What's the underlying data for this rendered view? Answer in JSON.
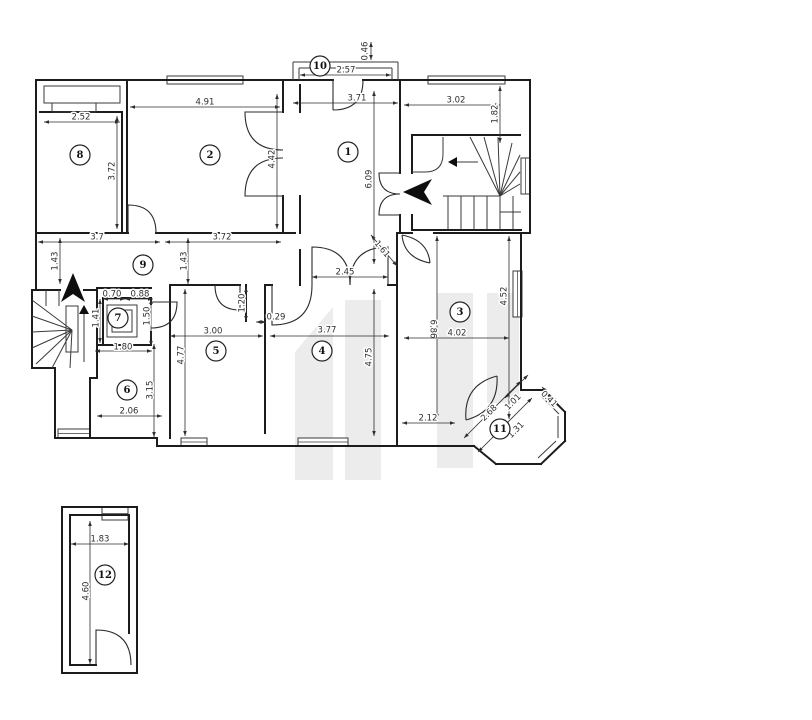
{
  "palette": {
    "background": "#ffffff",
    "wall": "#1c1c1c",
    "thin_line": "#3a3a3a",
    "door": "#2b2b2b",
    "dim": "#2e2e2e",
    "arrow_fill": "#0e0e0e",
    "watermark": "#ececec",
    "badge_fill": "#ffffff",
    "badge_stroke": "#222222"
  },
  "plan": {
    "walls": [
      [
        36,
        80,
        293,
        80
      ],
      [
        398,
        80,
        530,
        80
      ],
      [
        530,
        80,
        530,
        233
      ],
      [
        530,
        233,
        521,
        233
      ],
      [
        521,
        233,
        521,
        390
      ],
      [
        521,
        390,
        543,
        390
      ],
      [
        543,
        390,
        565,
        412
      ],
      [
        565,
        412,
        565,
        441
      ],
      [
        565,
        441,
        541,
        464
      ],
      [
        541,
        464,
        496,
        464
      ],
      [
        496,
        464,
        474,
        446
      ],
      [
        474,
        446,
        157,
        446
      ],
      [
        157,
        446,
        157,
        438
      ],
      [
        157,
        438,
        55,
        438
      ],
      [
        55,
        438,
        55,
        368
      ],
      [
        55,
        368,
        32,
        368
      ],
      [
        32,
        368,
        32,
        290
      ],
      [
        32,
        290,
        36,
        290
      ],
      [
        36,
        290,
        36,
        80
      ],
      [
        40,
        112,
        122,
        112
      ],
      [
        122,
        112,
        122,
        233
      ],
      [
        127,
        80,
        127,
        233
      ],
      [
        36,
        233,
        128,
        233
      ],
      [
        156,
        233,
        295,
        233
      ],
      [
        283,
        80,
        283,
        112
      ],
      [
        283,
        196,
        283,
        233
      ],
      [
        300,
        85,
        300,
        112
      ],
      [
        300,
        196,
        300,
        233
      ],
      [
        300,
        250,
        300,
        285
      ],
      [
        400,
        80,
        400,
        173
      ],
      [
        400,
        215,
        400,
        233
      ],
      [
        400,
        233,
        412,
        233
      ],
      [
        412,
        135,
        520,
        135
      ],
      [
        412,
        135,
        412,
        173
      ],
      [
        412,
        215,
        412,
        230
      ],
      [
        412,
        230,
        521,
        230
      ],
      [
        397,
        233,
        400,
        233
      ],
      [
        434,
        233,
        521,
        233
      ],
      [
        397,
        233,
        397,
        446
      ],
      [
        170,
        285,
        240,
        285
      ],
      [
        265,
        285,
        272,
        285
      ],
      [
        388,
        285,
        397,
        285
      ],
      [
        246,
        285,
        246,
        321
      ],
      [
        265,
        285,
        265,
        321
      ],
      [
        265,
        321,
        265,
        393
      ],
      [
        265,
        393,
        265,
        433
      ],
      [
        170,
        285,
        170,
        438
      ],
      [
        90,
        438,
        90,
        378
      ],
      [
        90,
        378,
        97,
        378
      ],
      [
        97,
        378,
        97,
        345
      ],
      [
        97,
        345,
        151,
        345
      ],
      [
        103,
        298,
        151,
        298
      ],
      [
        103,
        298,
        103,
        345
      ],
      [
        151,
        298,
        151,
        304
      ],
      [
        151,
        332,
        151,
        345
      ],
      [
        32,
        290,
        60,
        290
      ],
      [
        84,
        290,
        97,
        290
      ],
      [
        97,
        290,
        97,
        368
      ],
      [
        97,
        288,
        151,
        288
      ],
      [
        293,
        80,
        333,
        80
      ],
      [
        363,
        80,
        398,
        80
      ],
      [
        62,
        507,
        137,
        507
      ],
      [
        137,
        507,
        137,
        673
      ],
      [
        137,
        673,
        62,
        673
      ],
      [
        62,
        673,
        62,
        507
      ],
      [
        70,
        515,
        70,
        665
      ],
      [
        70,
        665,
        96,
        665
      ],
      [
        70,
        515,
        129,
        515
      ],
      [
        129,
        515,
        129,
        633
      ]
    ],
    "thin": [
      [
        293,
        62,
        398,
        62
      ],
      [
        293,
        62,
        293,
        80
      ],
      [
        398,
        62,
        398,
        80
      ],
      [
        299,
        68,
        392,
        68
      ],
      [
        299,
        68,
        299,
        80
      ],
      [
        392,
        68,
        392,
        80
      ],
      [
        448,
        196,
        448,
        229
      ],
      [
        461,
        196,
        461,
        229
      ],
      [
        474,
        196,
        474,
        229
      ],
      [
        487,
        196,
        487,
        229
      ],
      [
        500,
        196,
        500,
        229
      ],
      [
        513,
        196,
        513,
        229
      ],
      [
        500,
        212,
        521,
        212
      ],
      [
        443,
        196,
        500,
        196
      ],
      [
        500,
        196,
        470,
        137
      ],
      [
        500,
        196,
        484,
        137
      ],
      [
        500,
        196,
        498,
        137
      ],
      [
        500,
        196,
        512,
        143
      ],
      [
        500,
        196,
        520,
        155
      ],
      [
        500,
        196,
        520,
        172
      ],
      [
        500,
        196,
        520,
        184
      ],
      [
        72,
        330,
        32,
        300
      ],
      [
        72,
        330,
        32,
        316
      ],
      [
        72,
        330,
        32,
        332
      ],
      [
        72,
        330,
        32,
        348
      ],
      [
        72,
        330,
        36,
        364
      ],
      [
        72,
        330,
        52,
        368
      ],
      [
        72,
        330,
        70,
        368
      ],
      [
        46,
        290,
        46,
        306
      ],
      [
        59,
        290,
        59,
        306
      ],
      [
        478,
        162,
        452,
        162
      ],
      [
        84,
        362,
        84,
        312
      ],
      [
        541,
        396,
        559,
        414
      ],
      [
        558,
        416,
        558,
        438
      ],
      [
        556,
        441,
        538,
        458
      ]
    ],
    "paths": [
      "M 412,172 L 425,172 Q 443,172 443,154 L 443,137"
    ],
    "rects": [
      [
        44,
        86,
        76,
        17
      ],
      [
        52,
        103,
        44,
        9
      ],
      [
        107,
        305,
        30,
        32
      ],
      [
        112,
        310,
        20,
        22
      ],
      [
        66,
        306,
        12,
        46
      ]
    ],
    "windows": [
      [
        167,
        76,
        76,
        8
      ],
      [
        428,
        76,
        77,
        8
      ],
      [
        521,
        158,
        9,
        36
      ],
      [
        513,
        271,
        9,
        46
      ],
      [
        58,
        429,
        32,
        9
      ],
      [
        181,
        438,
        26,
        8
      ],
      [
        298,
        438,
        50,
        8
      ],
      [
        102,
        507,
        26,
        13
      ]
    ],
    "doors": [
      "M 333,110 Q 363,110 363,80 M 333,110 L 333,80",
      "M 128,233 L 128,205 Q 156,205 156,233",
      "M 283,112 L 245,112 Q 245,150 283,150",
      "M 283,196 L 245,196 Q 245,158 283,158",
      "M 400,173 L 379,173 Q 379,194 400,194",
      "M 400,215 L 379,215 Q 379,194 400,194",
      "M 312,285 L 312,247 Q 350,247 350,285",
      "M 388,285 L 388,247 Q 350,247 350,285",
      "M 272,285 L 272,325 Q 312,325 312,285",
      "M 240,285 L 240,310 Q 215,310 215,285",
      "M 402,235 Q 428,240 430,263",
      "M 402,235 Q 404,258 430,263",
      "M 151,302 L 177,302 Q 177,328 151,328",
      "M 466,420 Q 499,411 497,376",
      "M 466,420 Q 463,385 497,376",
      "M 96,665 L 96,630 Q 131,630 131,665"
    ],
    "arrows": [
      [
        [
          403,
          192
        ],
        [
          432,
          179
        ],
        [
          424,
          192
        ],
        [
          432,
          205
        ]
      ],
      [
        [
          73,
          273
        ],
        [
          85,
          302
        ],
        [
          73,
          294
        ],
        [
          61,
          302
        ]
      ],
      [
        [
          448,
          162
        ],
        [
          457,
          157
        ],
        [
          457,
          167
        ]
      ],
      [
        [
          84,
          305
        ],
        [
          79,
          314
        ],
        [
          89,
          314
        ]
      ]
    ],
    "watermark": [
      [
        [
          295,
          352
        ],
        [
          333,
          307
        ],
        [
          333,
          480
        ],
        [
          295,
          480
        ]
      ],
      [
        [
          345,
          300
        ],
        [
          381,
          300
        ],
        [
          381,
          480
        ],
        [
          345,
          480
        ]
      ],
      [
        [
          437,
          293
        ],
        [
          473,
          293
        ],
        [
          473,
          468
        ],
        [
          437,
          468
        ]
      ],
      [
        [
          487,
          293
        ],
        [
          519,
          293
        ],
        [
          519,
          403
        ],
        [
          487,
          403
        ]
      ]
    ],
    "dims": [
      {
        "t": "2.52",
        "x": 81,
        "y": 117,
        "r": 0,
        "l": [
          44,
          122,
          120,
          122
        ]
      },
      {
        "t": "3.72",
        "x": 112,
        "y": 171,
        "r": -90,
        "l": [
          117,
          116,
          117,
          229
        ]
      },
      {
        "t": "4.91",
        "x": 205,
        "y": 102,
        "r": 0,
        "l": [
          130,
          107,
          280,
          107
        ]
      },
      {
        "t": "4.42",
        "x": 272,
        "y": 159,
        "r": -90,
        "l": [
          277,
          94,
          277,
          229
        ]
      },
      {
        "t": "0.46",
        "x": 365,
        "y": 51,
        "r": -90,
        "l": [
          371,
          42,
          371,
          60
        ]
      },
      {
        "t": "2.57",
        "x": 346,
        "y": 70,
        "r": 0,
        "l": [
          300,
          75,
          391,
          75
        ]
      },
      {
        "t": "3.71",
        "x": 357,
        "y": 98,
        "r": 0,
        "l": [
          293,
          103,
          398,
          103
        ]
      },
      {
        "t": "3.02",
        "x": 456,
        "y": 100,
        "r": 0,
        "l": [
          404,
          105,
          500,
          105
        ]
      },
      {
        "t": "1.82",
        "x": 495,
        "y": 114,
        "r": -90,
        "l": [
          500,
          86,
          500,
          143
        ]
      },
      {
        "t": "6.09",
        "x": 369,
        "y": 179,
        "r": -90,
        "l": [
          374,
          91,
          374,
          264
        ]
      },
      {
        "t": "3.7",
        "x": 97,
        "y": 237,
        "r": 0,
        "l": [
          38,
          242,
          160,
          242
        ]
      },
      {
        "t": "3.72",
        "x": 222,
        "y": 237,
        "r": 0,
        "l": [
          165,
          242,
          281,
          242
        ]
      },
      {
        "t": "1.43",
        "x": 55,
        "y": 261,
        "r": -90,
        "l": [
          60,
          238,
          60,
          284
        ]
      },
      {
        "t": "1.43",
        "x": 184,
        "y": 261,
        "r": -90,
        "l": [
          188,
          238,
          188,
          284
        ]
      },
      {
        "t": "2.45",
        "x": 345,
        "y": 272,
        "r": 0,
        "l": [
          312,
          277,
          388,
          277
        ]
      },
      {
        "t": "1.61",
        "x": 382,
        "y": 249,
        "r": 50,
        "l": [
          371,
          235,
          397,
          266
        ]
      },
      {
        "t": "4.52",
        "x": 504,
        "y": 296,
        "r": -90,
        "l": [
          509,
          236,
          509,
          419
        ]
      },
      {
        "t": "6.86",
        "x": 433,
        "y": 329,
        "r": 90,
        "l": [
          437,
          236,
          437,
          419
        ]
      },
      {
        "t": "4.02",
        "x": 457,
        "y": 333,
        "r": 0,
        "l": [
          404,
          338,
          509,
          338
        ]
      },
      {
        "t": "2.12",
        "x": 428,
        "y": 418,
        "r": 0,
        "l": [
          402,
          423,
          455,
          423
        ]
      },
      {
        "t": "2.68",
        "x": 489,
        "y": 413,
        "r": -45,
        "l": [
          464,
          438,
          521,
          381
        ]
      },
      {
        "t": "1.01",
        "x": 513,
        "y": 402,
        "r": -45,
        "l": [
          505,
          398,
          528,
          375
        ]
      },
      {
        "t": "1.31",
        "x": 516,
        "y": 430,
        "r": -45,
        "l": [
          478,
          452,
          532,
          398
        ]
      },
      {
        "t": "0.41",
        "x": 549,
        "y": 399,
        "r": 45,
        "l": [
          542,
          387,
          558,
          403
        ]
      },
      {
        "t": "0.70",
        "x": 112,
        "y": 294,
        "r": 0,
        "l": [
          103,
          299,
          125,
          299
        ]
      },
      {
        "t": "0.88",
        "x": 140,
        "y": 294,
        "r": 0,
        "l": [
          125,
          299,
          153,
          299
        ]
      },
      {
        "t": "1.41",
        "x": 96,
        "y": 318,
        "r": -90,
        "l": [
          100,
          299,
          100,
          343
        ]
      },
      {
        "t": "1.50",
        "x": 147,
        "y": 316,
        "r": -90,
        "l": [
          151,
          299,
          151,
          346
        ]
      },
      {
        "t": "1.80",
        "x": 123,
        "y": 347,
        "r": 0,
        "l": [
          95,
          351,
          152,
          351
        ]
      },
      {
        "t": "3.15",
        "x": 150,
        "y": 390,
        "r": -90,
        "l": [
          154,
          344,
          154,
          437
        ]
      },
      {
        "t": "2.06",
        "x": 129,
        "y": 411,
        "r": 0,
        "l": [
          97,
          416,
          162,
          416
        ]
      },
      {
        "t": "3.00",
        "x": 213,
        "y": 331,
        "r": 0,
        "l": [
          170,
          336,
          263,
          336
        ]
      },
      {
        "t": "4.77",
        "x": 181,
        "y": 355,
        "r": -90,
        "l": [
          185,
          289,
          185,
          436
        ]
      },
      {
        "t": "1.20",
        "x": 242,
        "y": 303,
        "r": -90,
        "l": [
          246,
          287,
          246,
          321
        ]
      },
      {
        "t": "0.29",
        "x": 276,
        "y": 317,
        "r": 0,
        "l": [
          256,
          322,
          266,
          322
        ]
      },
      {
        "t": "3.77",
        "x": 327,
        "y": 330,
        "r": 0,
        "l": [
          270,
          336,
          389,
          336
        ]
      },
      {
        "t": "4.75",
        "x": 369,
        "y": 357,
        "r": -90,
        "l": [
          374,
          289,
          374,
          436
        ]
      },
      {
        "t": "1.83",
        "x": 100,
        "y": 539,
        "r": 0,
        "l": [
          71,
          544,
          129,
          544
        ]
      },
      {
        "t": "4.60",
        "x": 86,
        "y": 591,
        "r": -90,
        "l": [
          90,
          521,
          90,
          664
        ]
      }
    ],
    "rooms": [
      {
        "n": "1",
        "x": 348,
        "y": 152
      },
      {
        "n": "2",
        "x": 210,
        "y": 155
      },
      {
        "n": "3",
        "x": 460,
        "y": 312
      },
      {
        "n": "4",
        "x": 322,
        "y": 351
      },
      {
        "n": "5",
        "x": 216,
        "y": 351
      },
      {
        "n": "6",
        "x": 127,
        "y": 390
      },
      {
        "n": "7",
        "x": 118,
        "y": 318
      },
      {
        "n": "8",
        "x": 80,
        "y": 155
      },
      {
        "n": "9",
        "x": 143,
        "y": 265
      },
      {
        "n": "10",
        "x": 320,
        "y": 66
      },
      {
        "n": "11",
        "x": 500,
        "y": 429
      },
      {
        "n": "12",
        "x": 105,
        "y": 575
      }
    ]
  }
}
